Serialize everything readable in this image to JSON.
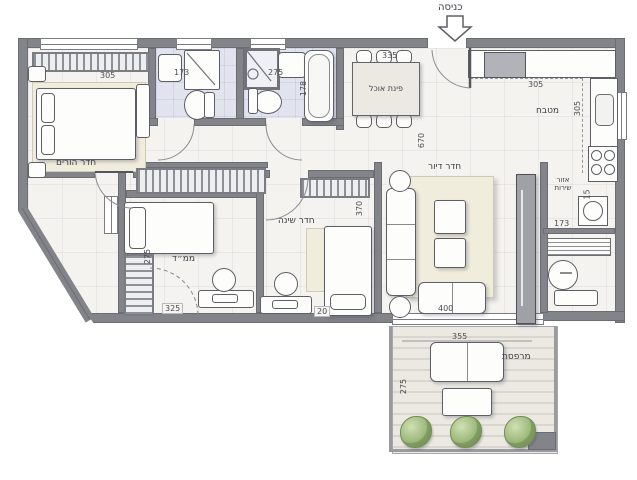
{
  "labels": {
    "entrance": "כניסה",
    "dining": "פינת אוכל",
    "kitchen": "מטבח",
    "living": "חדר דיור",
    "parents": "חדר הורים",
    "bedroom": "חדר שינה",
    "mamad": "ממ״ד",
    "service_line1": "אזור",
    "service_line2": "שירות",
    "balcony": "מרפסת"
  },
  "dimensions": {
    "dining_width": "335",
    "kitchen_width": "305",
    "kitchen_depth": "305",
    "living_length": "670",
    "parents_width": "305",
    "bath_left_width": "173",
    "bath_right_width": "275",
    "bathtub_length": "178",
    "bedroom_depth": "370",
    "mamad_depth": "275",
    "mamad_width": "325",
    "bedroom_gap": "20",
    "living_width": "400",
    "balcony_width": "355",
    "balcony_depth": "275",
    "service_width": "173",
    "service_niche_depth": "15"
  },
  "colors": {
    "wall": "#83838a",
    "floor": "#f5f3ef",
    "bath_floor": "#e1e3ef",
    "plant_green": "#8fae6e"
  }
}
